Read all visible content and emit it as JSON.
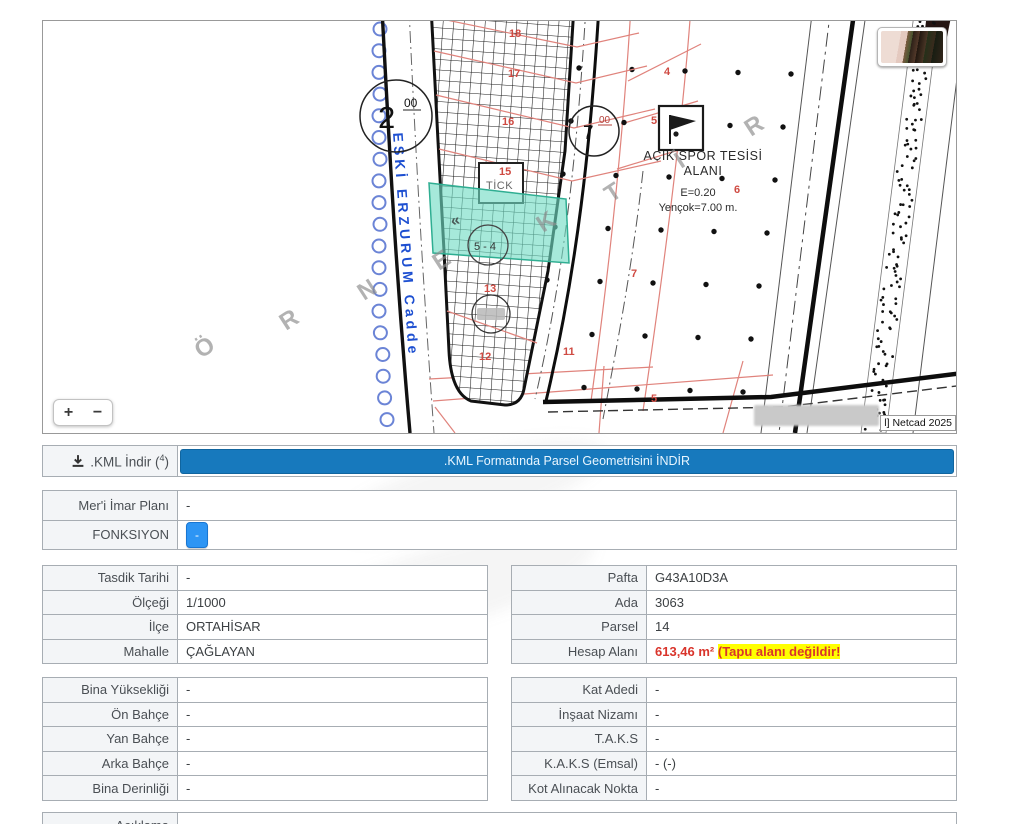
{
  "map": {
    "street": "ESKİ ERZURUM Cadde",
    "watermark": {
      "l0": "Ö",
      "l1": "R",
      "l2": "N",
      "l3": "E",
      "l4": "K",
      "l5": "T",
      "l6": "İ",
      "l7": "R"
    },
    "chevrons": "«",
    "junction_large": {
      "num": "2",
      "sup": "00"
    },
    "junction_small": {
      "num": "7",
      "sup": "00"
    },
    "tick_box": "TİCK",
    "subject_circle": "5 - 4",
    "parcels": {
      "p18": "18",
      "p17": "17",
      "p16": "16",
      "p15": "15",
      "p13": "13",
      "p12": "12",
      "p11": "11",
      "p7": "7",
      "p6": "6",
      "p5": "5",
      "p4": "4",
      "p5b": "5"
    },
    "spor": {
      "line1": "AÇIK SPOR TESİSİ",
      "line2": "ALANI",
      "e": "E=0.20",
      "yencok": "Yençok=7.00 m."
    },
    "attribution": "l] Netcad 2025",
    "zoom_in": "+",
    "zoom_out": "−"
  },
  "kml": {
    "label_prefix": ".KML İndir (",
    "label_sup": "4",
    "label_suffix": ")",
    "button": ".KML Formatında Parsel Geometrisini İNDİR"
  },
  "plan": {
    "meri_label": "Mer'i İmar Planı",
    "meri_value": "-",
    "fonksiyon_label": "FONKSIYON",
    "fonksiyon_value": "-"
  },
  "info1_left": {
    "rows": [
      [
        "Tasdik Tarihi",
        "-"
      ],
      [
        "Ölçeği",
        "1/1000"
      ],
      [
        "İlçe",
        "ORTAHİSAR"
      ],
      [
        "Mahalle",
        "ÇAĞLAYAN"
      ]
    ]
  },
  "info1_right": {
    "rows": [
      [
        "Pafta",
        "G43A10D3A"
      ],
      [
        "Ada",
        "3063"
      ],
      [
        "Parsel",
        "14"
      ]
    ],
    "hesap_label": "Hesap Alanı",
    "hesap_red": "613,46 m² ",
    "hesap_highlight": "(Tapu alanı değildir!"
  },
  "info2_left": {
    "rows": [
      [
        "Bina Yüksekliği",
        "-"
      ],
      [
        "Ön Bahçe",
        "-"
      ],
      [
        "Yan Bahçe",
        "-"
      ],
      [
        "Arka Bahçe",
        "-"
      ],
      [
        "Bina Derinliği",
        "-"
      ]
    ]
  },
  "info2_right": {
    "rows": [
      [
        "Kat Adedi",
        "-"
      ],
      [
        "İnşaat Nizamı",
        "-"
      ],
      [
        "T.A.K.S",
        "-"
      ],
      [
        "K.A.K.S (Emsal)",
        "- (-)"
      ],
      [
        "Kot Alınacak Nokta",
        "-"
      ]
    ]
  },
  "footer": {
    "aciklama": "Açıklama"
  },
  "colors": {
    "accent_blue": "#1779bd",
    "button_blue": "#2d95f4",
    "alert_red": "#d9342b",
    "highlight_yellow": "#ffff00",
    "teal_parcel": "#6fdcc4",
    "street_blue": "#1d4fd1"
  }
}
